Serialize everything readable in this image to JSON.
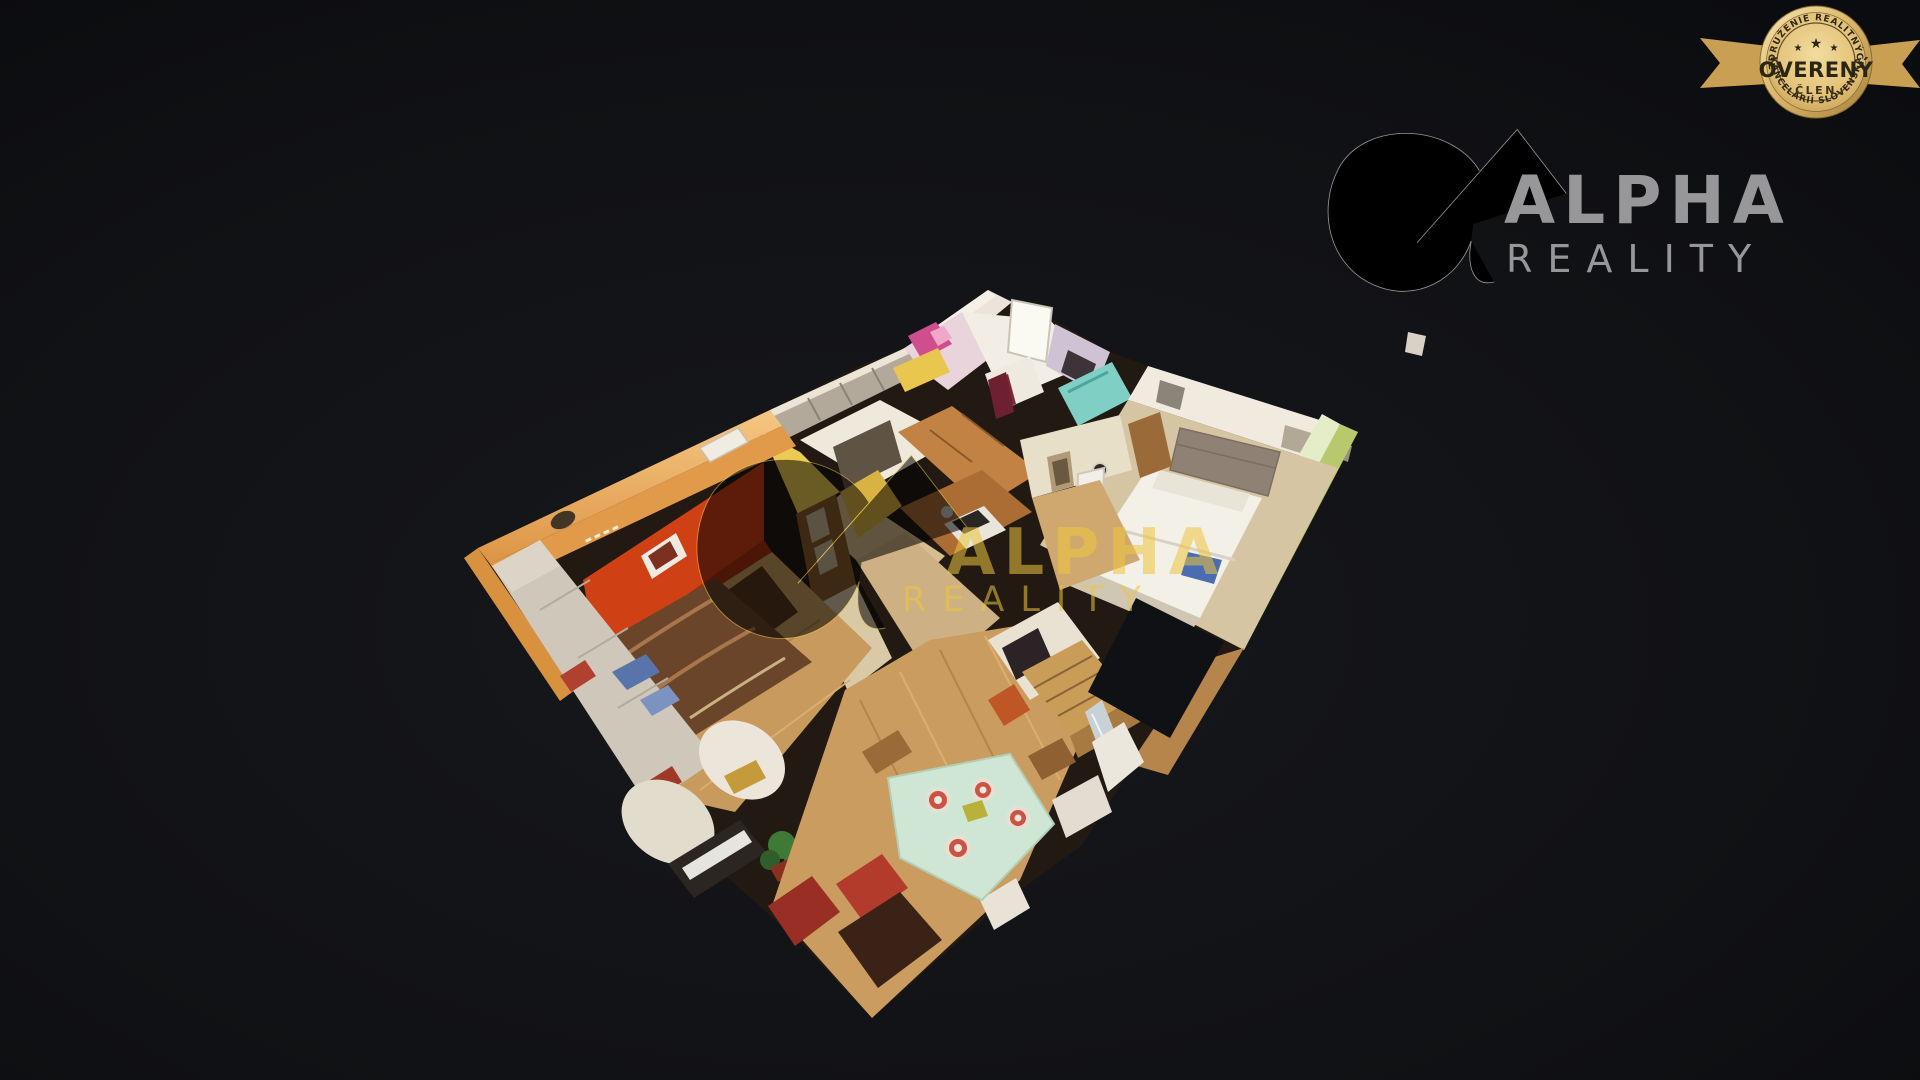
{
  "page": {
    "background": "#0f1013",
    "viewer": "3d-dollhouse-tour"
  },
  "badge": {
    "arc_top": "ZDRUŽENIE REALITNÝCH",
    "arc_bottom": "KANCELÁRIÍ SLOVENSKA",
    "title": "OVERENÝ",
    "subtitle": "ČLEN",
    "star": "★",
    "colors": {
      "gold_light": "#f2dfa4",
      "gold": "#d4ab62",
      "gold_deep": "#9c7a38",
      "text": "#2b2514"
    }
  },
  "brand_logo": {
    "name": "ALPHA",
    "sub": "REALITY",
    "color": "#97979a"
  },
  "watermark": {
    "name": "ALPHA",
    "sub": "REALITY",
    "color": "#eec63e",
    "opacity": 0.55
  },
  "dollhouse": {
    "rooms": [
      "living-room",
      "hallway",
      "kitchen",
      "bathroom",
      "corridor",
      "bedroom",
      "dining-area"
    ],
    "colors": {
      "wall_orange": "#e19a4a",
      "wall_red": "#cf4015",
      "wall_yellow": "#eccb54",
      "wall_green": "#b7c96c",
      "wall_pink": "#cf4f8e",
      "floor_wood": "#c89a5e",
      "rug_brown": "#6a452a",
      "sofa_gray": "#cfc7b9",
      "bed_white": "#f3f0e8",
      "table_mint": "#cfe6d4",
      "cabinet_wood": "#c28244"
    }
  }
}
